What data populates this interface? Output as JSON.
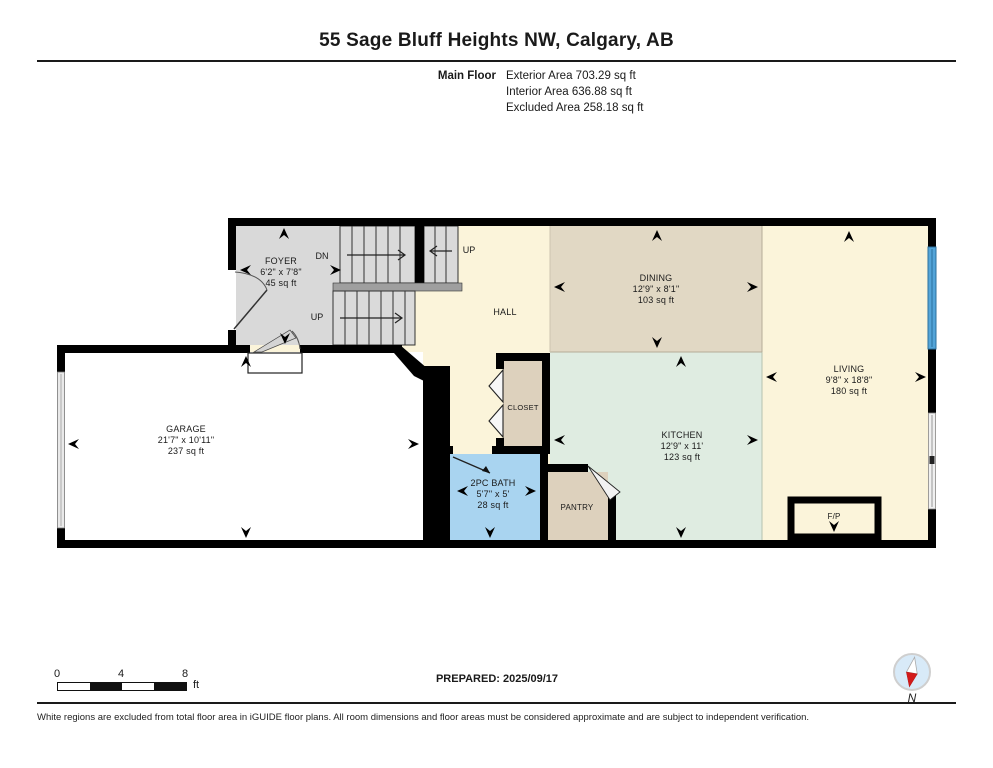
{
  "header": {
    "title": "55 Sage Bluff Heights NW, Calgary, AB",
    "floor_label": "Main Floor",
    "stats": [
      "Exterior Area 703.29 sq ft",
      "Interior Area 636.88 sq ft",
      "Excluded Area 258.18 sq ft"
    ]
  },
  "rooms": {
    "foyer": {
      "name": "FOYER",
      "dims": "6'2\" x 7'8\"",
      "area": "45 sq ft"
    },
    "dining": {
      "name": "DINING",
      "dims": "12'9\" x 8'1\"",
      "area": "103 sq ft"
    },
    "living": {
      "name": "LIVING",
      "dims": "9'8\" x 18'8\"",
      "area": "180 sq ft"
    },
    "garage": {
      "name": "GARAGE",
      "dims": "21'7\" x 10'11\"",
      "area": "237 sq ft"
    },
    "kitchen": {
      "name": "KITCHEN",
      "dims": "12'9\" x 11'",
      "area": "123 sq ft"
    },
    "bath": {
      "name": "2PC BATH",
      "dims": "5'7\" x 5'",
      "area": "28 sq ft"
    },
    "hall": {
      "name": "HALL"
    },
    "closet": {
      "name": "CLOSET"
    },
    "pantry": {
      "name": "PANTRY"
    },
    "fireplace": {
      "name": "F/P"
    }
  },
  "stairs": {
    "dn": "DN",
    "up_left": "UP",
    "up_right": "UP"
  },
  "scale_bar": {
    "tick0": "0",
    "tick4": "4",
    "tick8": "8",
    "unit": "ft"
  },
  "footer": {
    "prepared": "PREPARED: 2025/09/17",
    "compass_label": "N",
    "disclaimer": "White regions are excluded from total floor area in iGUIDE floor plans. All room dimensions and floor areas must be considered approximate and are subject to independent verification."
  },
  "colors": {
    "wall": "#000000",
    "foyer_bg": "#d9d9d9",
    "stair_tread": "#dadada",
    "landing": "#9f9f9f",
    "cream_bg": "#fbf4da",
    "dining_bg": "#e1d8c4",
    "kitchen_bg": "#dfece1",
    "closet_bg": "#ddd1bd",
    "pantry_bg": "#ddd1bd",
    "bath_bg": "#a9d4f0",
    "garage_bg": "#ffffff",
    "window": "#53a4d8",
    "slider": "#f0f0f0"
  }
}
